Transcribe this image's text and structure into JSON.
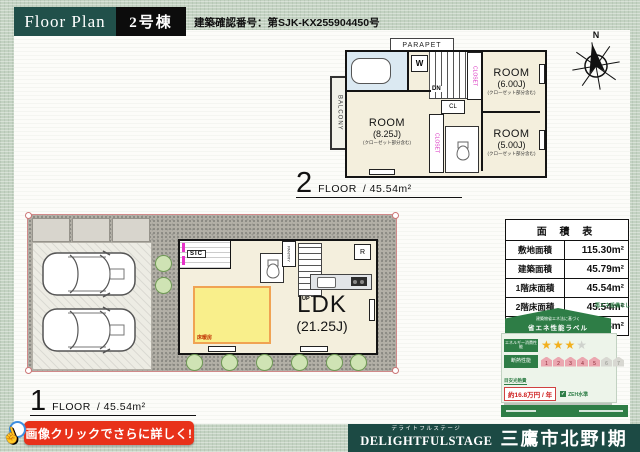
{
  "header": {
    "title": "Floor Plan",
    "building": "2号棟",
    "confirmation": "建築確認番号：第SJK-KX255904450号"
  },
  "floor2": {
    "number": "2",
    "floor_word": "FLOOR",
    "area": "/ 45.54m²",
    "parapet": "PARAPET",
    "balcony": "BALCONY",
    "washer": "W",
    "dn": "DN",
    "cl": "CL",
    "closet": "CLOSET",
    "rooms": [
      {
        "name": "ROOM",
        "size": "(6.00J)",
        "note": "(クローゼット部分含む)"
      },
      {
        "name": "ROOM",
        "size": "(5.00J)",
        "note": "(クローゼット部分含む)"
      },
      {
        "name": "ROOM",
        "size": "(8.25J)",
        "note": "(クローゼット部分含む)"
      }
    ]
  },
  "floor1": {
    "number": "1",
    "floor_word": "FLOOR",
    "area": "/ 45.54m²",
    "ldk": "LDK",
    "ldk_size": "(21.25J)",
    "sic": "SIC",
    "pantry": "PANTRY",
    "fridge": "R",
    "up": "UP",
    "floor_heating": "床暖房"
  },
  "compass": {
    "north": "N"
  },
  "area_table": {
    "title": "面 積 表",
    "rows": [
      {
        "label": "敷地面積",
        "value": "115.30m²"
      },
      {
        "label": "建築面積",
        "value": "45.79m²"
      },
      {
        "label": "1階床面積",
        "value": "45.54m²"
      },
      {
        "label": "2階床面積",
        "value": "45.54m²"
      },
      {
        "label": "延床面積",
        "value": "91.08m²"
      }
    ]
  },
  "energy_label": {
    "renewable_note": "再エネ設備なし",
    "law": "建築物省エネ法に基づく",
    "title": "省エネ性能ラベル",
    "energy_row": "エネルギー消費性能",
    "insulation_row": "断熱性能",
    "stars_filled": "★★★",
    "star_empty": "★",
    "scale": [
      "1",
      "2",
      "3",
      "4",
      "5",
      "6",
      "7"
    ],
    "cost_label": "目安光熱費",
    "cost_value": "約16.8万円 / 年",
    "zeh_check": "✓",
    "zeh": "ZEH水準"
  },
  "cta": {
    "text": "画像クリックでさらに詳しく!"
  },
  "footer": {
    "furigana": "デライトフルステージ",
    "brand": "DELIGHTFULSTAGE",
    "project": "三鷹市北野Ⅰ期"
  },
  "colors": {
    "teal": "#1c4a44",
    "red": "#e8321a",
    "magenta": "#d92bbf",
    "green": "#2e7d46",
    "star_gold": "#f2b01e"
  }
}
